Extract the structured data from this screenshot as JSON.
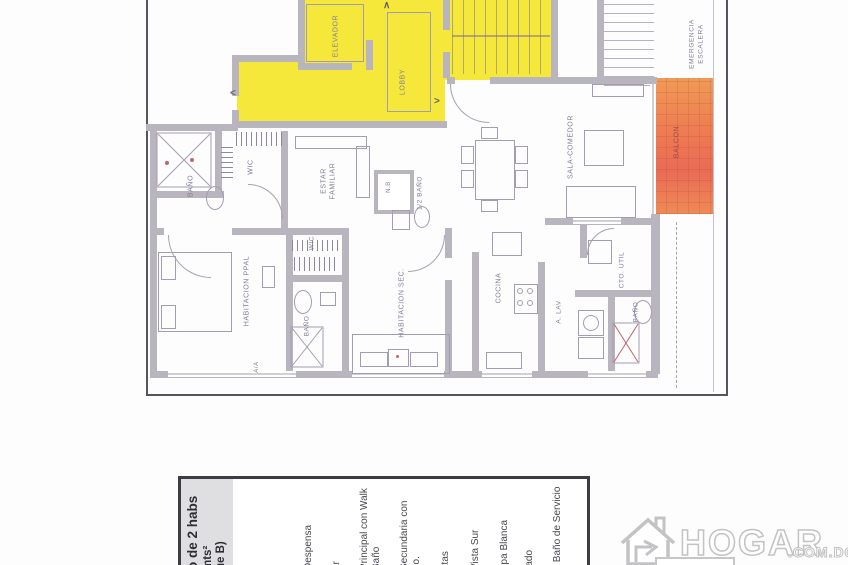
{
  "plan": {
    "labels": {
      "elevador": "ELEVADOR",
      "lobby": "LOBBY",
      "emergencia1": "EMERGENCIA",
      "emergencia2": "ESCALERA",
      "balcon": "BALCON",
      "bano_publico": "BAÑO",
      "wic1": "WIC",
      "estar1": "ESTAR",
      "estar2": "FAMILIAR",
      "medio_bano": "1/2 BAÑO",
      "nb": "N.B",
      "sala": "SALA-COMEDOR",
      "hab_ppal": "HABITACION PPAL",
      "wic2": "WIC",
      "bano_ppal": "BAÑO",
      "hab_sec": "HABITACION SEC.",
      "cocina": "COCINA",
      "alav": "A. LAV",
      "cto_util": "CTO. UTIL",
      "bano_serv": "BAÑO",
      "aa": "A/A"
    },
    "marks": {
      "chevron_left": "<",
      "chevron_right": ">",
      "chevron_up": "∧"
    }
  },
  "info_panel": {
    "title_fragments": [
      "o de 2 habs",
      "mts²",
      "ue B)"
    ],
    "feature_fragments": [
      "Despensa",
      "ar",
      "Principal con Walk",
      "Baño",
      "Secundaria con",
      "ño.",
      "atas",
      "Vista Sur",
      "opa Blanca",
      "rado",
      "y Baño de Servicio"
    ]
  },
  "watermark": {
    "brand": "HOGAR",
    "suffix": ".COM.DO"
  },
  "colors": {
    "highlight_yellow": "#f5e83a",
    "highlight_orange": "#ee7a52",
    "wall_gray": "#b9b5be",
    "line_purple": "#a49cb2",
    "label_purple": "#837b98",
    "watermark_gray": "#c3c2c4",
    "panel_border": "#3c3c44"
  }
}
